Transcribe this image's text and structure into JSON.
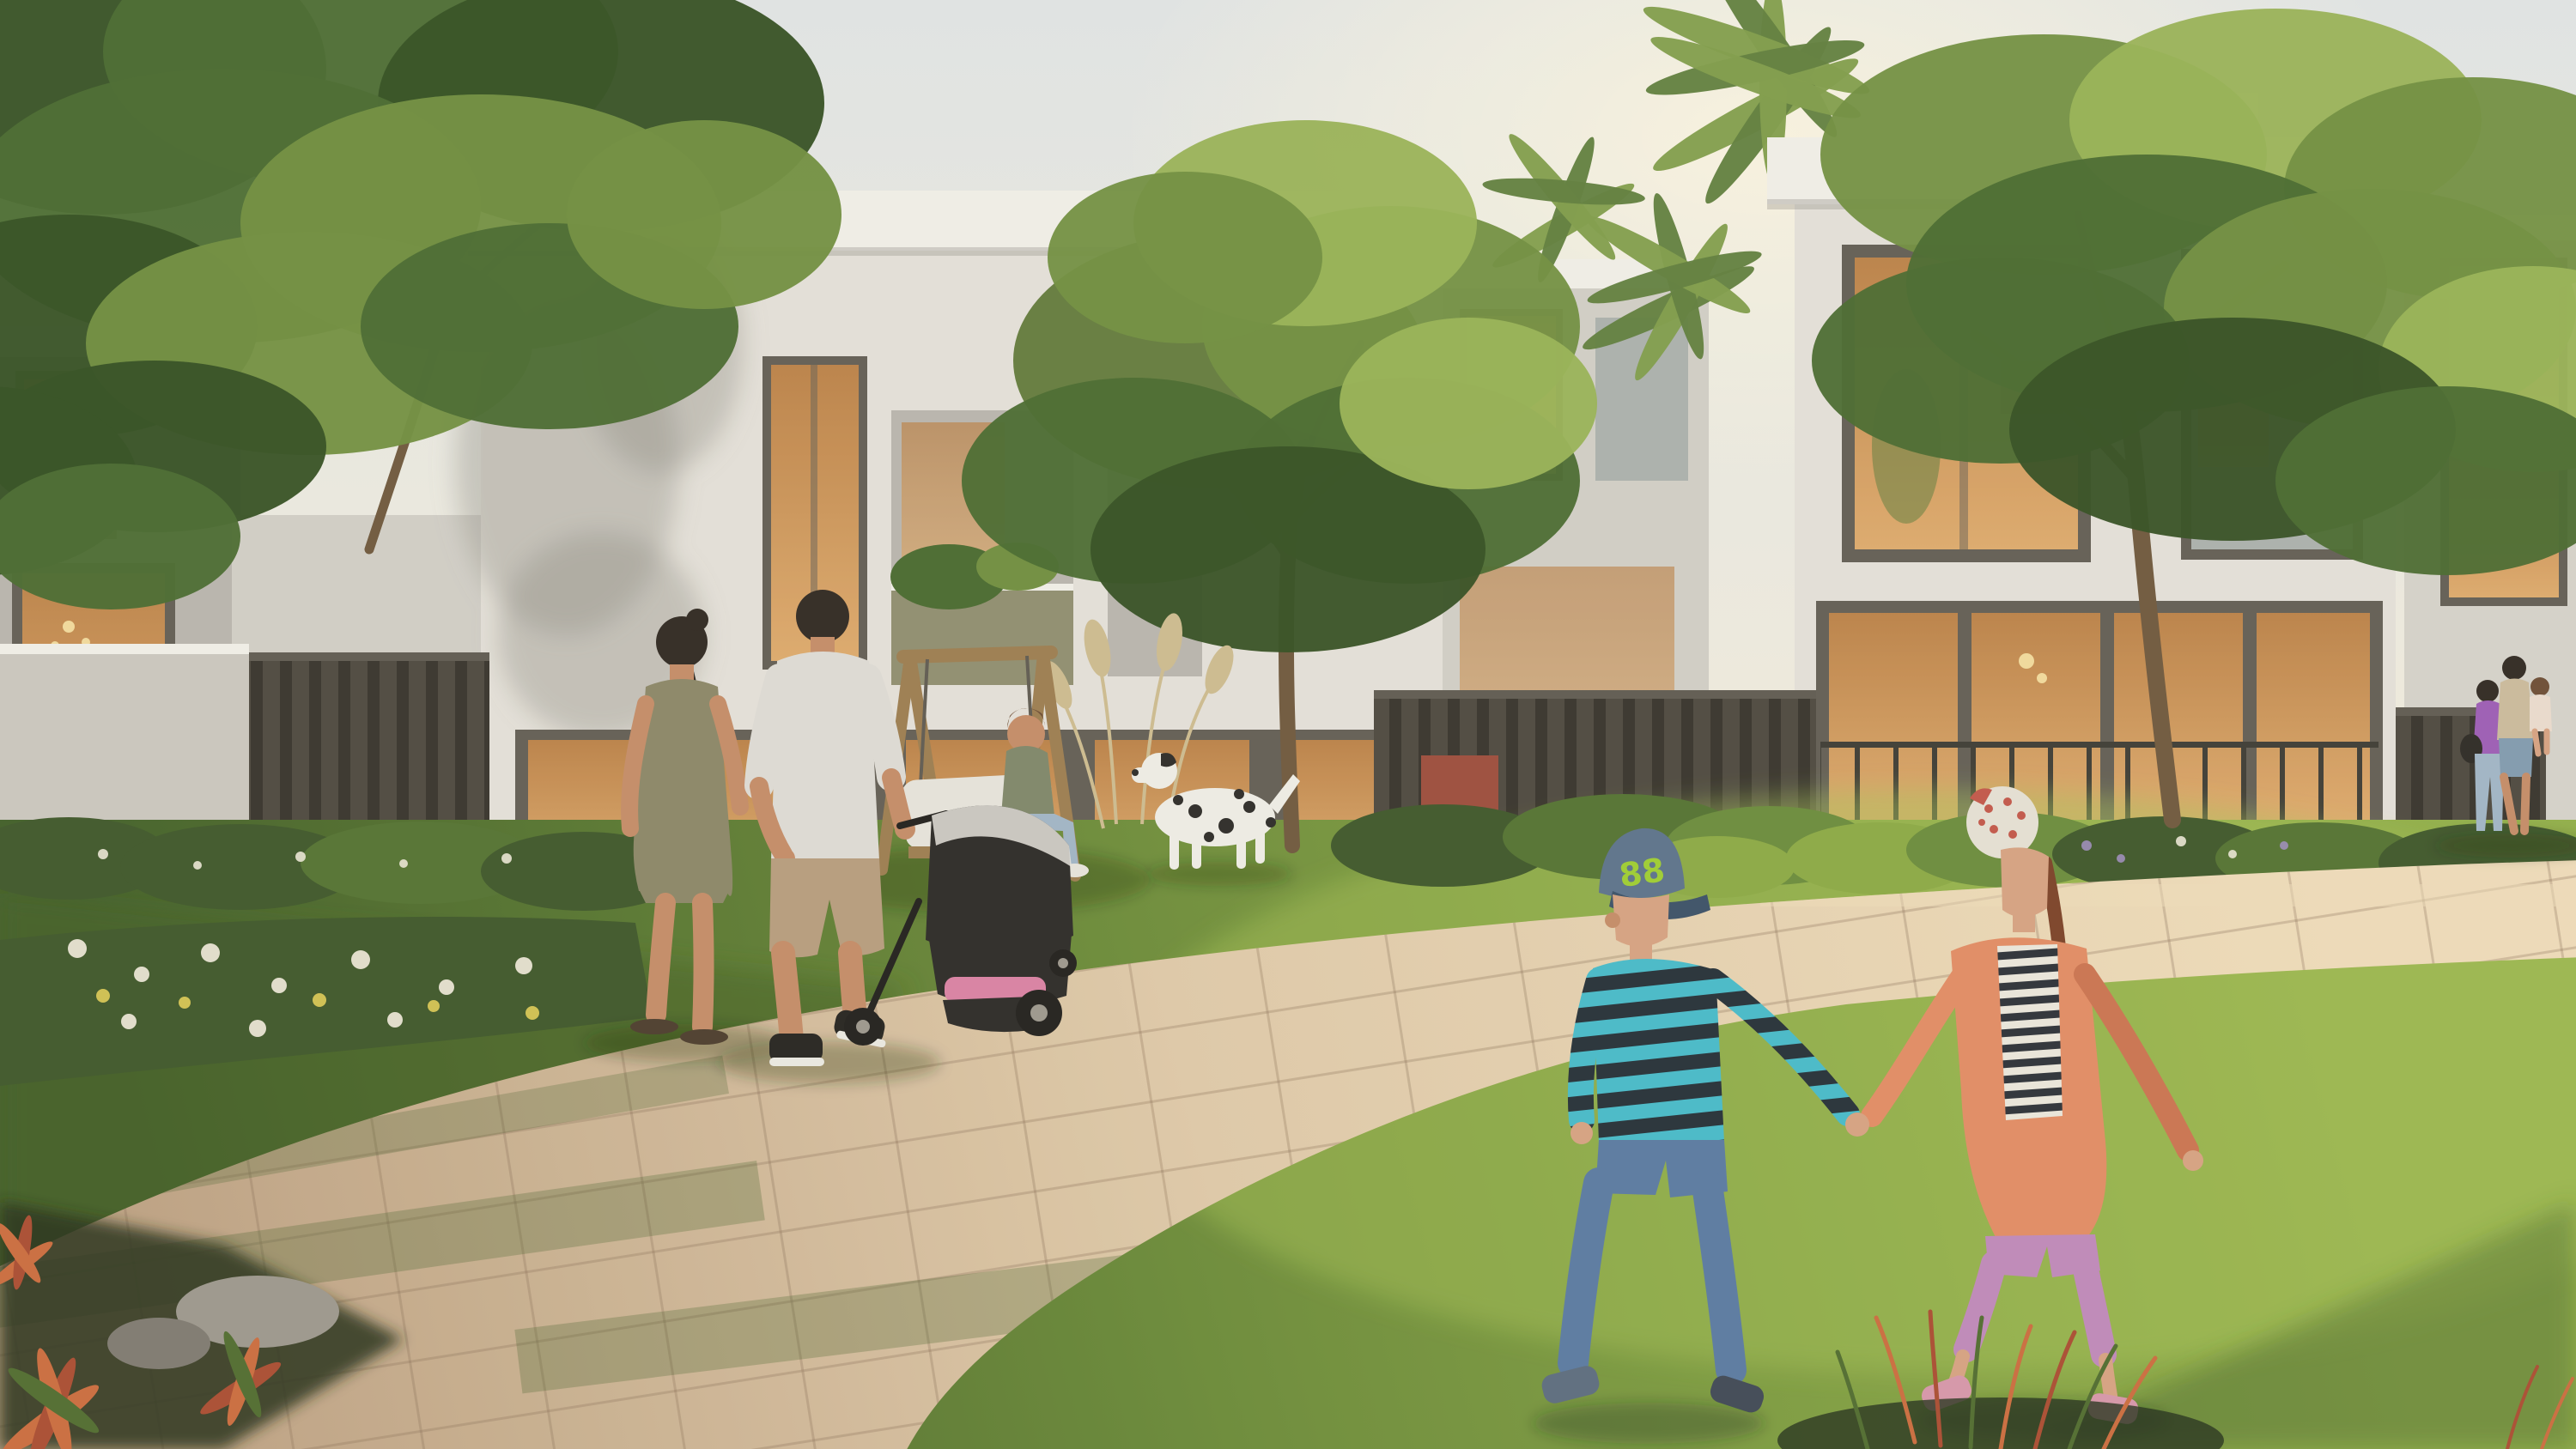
{
  "image": {
    "title": "Residential community courtyard rendering",
    "description": "Golden-hour architectural visualization: families strolling on a curved paver path through a landscaped lawn between modern white two-storey townhouses",
    "boy_cap_text": "88"
  },
  "scene": {
    "time_of_day": "late afternoon golden hour",
    "sky": "hazy pale warm sky",
    "buildings": "modern flat-roof white townhouses with warm lit glazing, balconies and slatted garden fences",
    "vegetation": "large overhanging tree top-left, olive trees, palms, hedges, flower beds, pampas grass, croton and reed plants",
    "people": [
      "woman in olive dress walking away",
      "man in light polo pushing black stroller with pink blanket",
      "woman seated on wooden A-frame swing bench",
      "dalmatian dog standing on lawn",
      "boy in striped jumper, jeans and blue cap walking on grass",
      "girl in coral cardigan, striped top, lilac capris and red-white bandana holding the boy's hand",
      "family of three standing by the far right fence"
    ]
  },
  "colors": {
    "sky_top": "#dfe2e3",
    "sky_mid": "#e9e7df",
    "sky_horizon": "#f1eadb",
    "sun_glow": "#fff6dd",
    "building_white": "#e2ded7",
    "building_shaded": "#b7b3ac",
    "building_wing": "#cfccc5",
    "building_far": "#d3d0c9",
    "roof_slab": "#efece6",
    "roof_shadow": "#8f8b84",
    "wall_light": "#c9c5bd",
    "window_frame": "#605b53",
    "glass_warm": "#dca86b",
    "glass_warm_deep": "#b97f46",
    "glass_cool": "#a9aeab",
    "interior_glow": "#f0d79a",
    "balustrade_olive": "#8e8c6e",
    "fence_dark": "#4b463e",
    "fence_gap": "#35312b",
    "fence_rail": "#5d5850",
    "metal_rail": "#3c3933",
    "hedge_dark": "#3d5529",
    "hedge_mid": "#527030",
    "hedge_sunlit": "#69893a",
    "bush_yellow": "#8aa743",
    "grass_sunlit": "#8fac47",
    "grass_mid": "#6d8c38",
    "grass_shade": "#3f5c26",
    "grass_hotspot": "#a3bf55",
    "tree_dark": "#324d20",
    "tree_mid": "#47682e",
    "tree_light": "#6e8c3e",
    "tree_highlight": "#96b054",
    "olive_canopy": "#5d7636",
    "palm_green": "#7e9a48",
    "palm_dark": "#5e7c3c",
    "trunk_brown": "#6d563c",
    "pampas_beige": "#cbb98e",
    "path_light": "#ddc7a7",
    "path_pale": "#ecd9b8",
    "path_shade": "#b89c7e",
    "paver_line": "#8a6f55",
    "flower_white": "#e9e4d4",
    "flower_yellow": "#d6c452",
    "lavender": "#9a8ab8",
    "plant_orange": "#c96a3d",
    "plant_rust": "#a84a30",
    "reed_green": "#4e6a2e",
    "rock_gray": "#9a958c",
    "rock_dark": "#7d786f",
    "soil_dark": "#23301a",
    "shadow_green": "#1e2b12",
    "skin": "#c28a66",
    "skin_light": "#d4a080",
    "hair_dark": "#2e2620",
    "hair_brown": "#6b4a33",
    "hair_auburn": "#7a4026",
    "dress_olive": "#8a8466",
    "polo_gray": "#dcd9d3",
    "shorts_beige": "#b59a7c",
    "shoe_dark": "#23211e",
    "sole_white": "#e8e6e0",
    "sandal_brown": "#4a3a2c",
    "stroller_black": "#2a2725",
    "stroller_frame": "#1f1d1b",
    "stroller_pink": "#d77fa2",
    "wood_swing": "#9a7b4f",
    "cushion_white": "#e4e1da",
    "sage_top": "#7d8468",
    "denim_light": "#9fb3c4",
    "dog_white": "#eceae4",
    "dog_spot": "#2b2926",
    "cap_blue": "#5a7089",
    "cap_brim": "#394f66",
    "cap_text_green": "#9ccb30",
    "stripe_teal": "#45b8c8",
    "stripe_navy": "#232e36",
    "jeans_blue": "#5878a0",
    "boy_shoe_left": "#5a6a7d",
    "boy_shoe_right": "#3e4654",
    "bandana_base": "#e3ded2",
    "bandana_red": "#c05548",
    "cardigan_coral": "#e08a63",
    "cardigan_shade": "#c9714e",
    "girl_stripe_light": "#e8e4da",
    "girl_stripe_dark": "#2b2f36",
    "capri_pink": "#bd86b8",
    "girl_shoe_pink": "#d494a8",
    "mom_purple": "#9a5ab4",
    "bag_black": "#2b2723",
    "dad_beige": "#c9b89a",
    "denim_shorts": "#7f98ad",
    "child_dress": "#e8d8cc",
    "bench_red": "#9a4a3a"
  }
}
